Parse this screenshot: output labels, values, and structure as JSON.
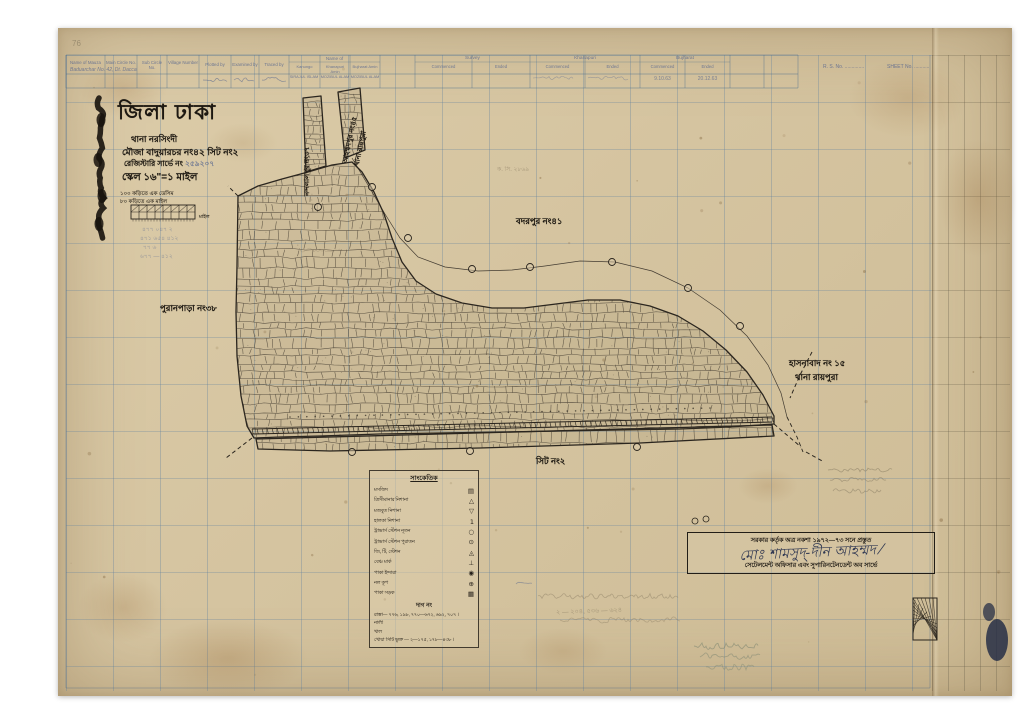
{
  "page": {
    "corner_number": "76",
    "rs_no_label": "R. S. No. ..............",
    "sheet_no_label": "SHEET No. ..........."
  },
  "header_table": {
    "columns": [
      "Name of Mauza",
      "Main Circle No.",
      "Sub Circle No.",
      "Village Number",
      "Plotted by",
      "Examined by",
      "Traced by"
    ],
    "name_of_group": "Name of",
    "name_subcols": [
      "Kanungo",
      "Khanapuri Amin",
      "Bujharat Amin"
    ],
    "stage_groups": [
      "Survey",
      "Khanapuri",
      "Bujharat"
    ],
    "commenced": "Commenced",
    "ended": "Ended",
    "mauza_value": "Baduarchar No. 42, Dt. Dacca",
    "kanungo_value": "SIRAJUL ISLAM",
    "khanapuri_amin_value": "MOZIBUL ALAM",
    "bujharat_amin_value": "MOZIBUL ALAM",
    "bujharat_commenced_value": "9.10.63",
    "bujharat_ended_value": "20.12.63"
  },
  "title_block": {
    "district": "জিলা ঢাকা",
    "thana": "থানা নরসিংদী",
    "mouza": "মৌজা বাদুয়ারচর নং৪২ সিট নং২",
    "survey": "রেজিস্টারি সার্ভে নং",
    "survey_value": "২৫৯২০৭",
    "scale": "স্কেল ১৬\"=১ মাইল",
    "note1": "১০০ কড়িতে এক ডেসিম",
    "note2": "৮০ কড়িতে এক মাইল",
    "scalebar_label": "মাইল"
  },
  "map_labels": {
    "badarpur": "বদরপুর নং৪১",
    "puranpara": "পুরানপাড়া নং৩৮",
    "sheet_label": "সিট নং২",
    "hasnabad_line1": "হাসনাবাদ নং ১৫",
    "hasnabad_line2": "থানা রায়পুরা",
    "nandalalpur": "নন্দলালপুর নং৩৭",
    "ahmmadpur_line1": "আহম্মদপুর নং৪৫",
    "ahmmadpur_line2": "থানা রায়পুরা"
  },
  "legend": {
    "title": "সাংকেতিক",
    "rows": [
      {
        "label": "মসজিদ",
        "symbol": "▤"
      },
      {
        "label": "ত্রিসীমানার নিশানা",
        "symbol": "△"
      },
      {
        "label": "মজবুত নিশানা",
        "symbol": "▽"
      },
      {
        "label": "হালকা নিশানা",
        "symbol": "1"
      },
      {
        "label": "ট্রাভার্স স্টেশন নূতন",
        "symbol": "○"
      },
      {
        "label": "ট্রাভার্স স্টেশন পুরাতন",
        "symbol": "⊙"
      },
      {
        "label": "জি, টি, স্টেশন",
        "symbol": "◬"
      },
      {
        "label": "বেঞ্চ মার্ক",
        "symbol": "⊥"
      },
      {
        "label": "পাকা ইন্দারা",
        "symbol": "◉"
      },
      {
        "label": "নল কূপ",
        "symbol": "⊕"
      },
      {
        "label": "পাকা সড়ক",
        "symbol": "▦"
      }
    ],
    "dag_heading": "দাগ নং",
    "dag_rows": [
      "রাস্তা— ৭৭৬, ১৯৮, ৭৭০—৬৭২, ৬৯২, ৭০৭ ।",
      "নালী",
      "খাল",
      "খোয়া সিটি ভুক্ত — ২—১৭৫, ১৭৮—৪৩৮ ।"
    ]
  },
  "stamp": {
    "line1": "সরকার কর্তৃক অত্র নকশা ১৯৭২—৭৩ সনে প্রস্তুত",
    "signature": "মোঃ শামসুদ্-দীন আহম্মদ ⁄",
    "line3": "সেটেলমেন্ট অফিসার এবং সুপারিনটেনডেন্ট অব সার্ভে"
  },
  "annotations": {
    "kc_note": "ক. সি. ২৮৬৯",
    "bottom_note": "২ — ২০৪, ৫৩৬ — ৬২৪",
    "blue_rows": [
      "৪৭৭ ০৪৭  ২",
      "৪৭১ ৬৫৪  ৪১২",
      "৭৭  ৬",
      "৬৭৭ — ৪১২"
    ]
  }
}
